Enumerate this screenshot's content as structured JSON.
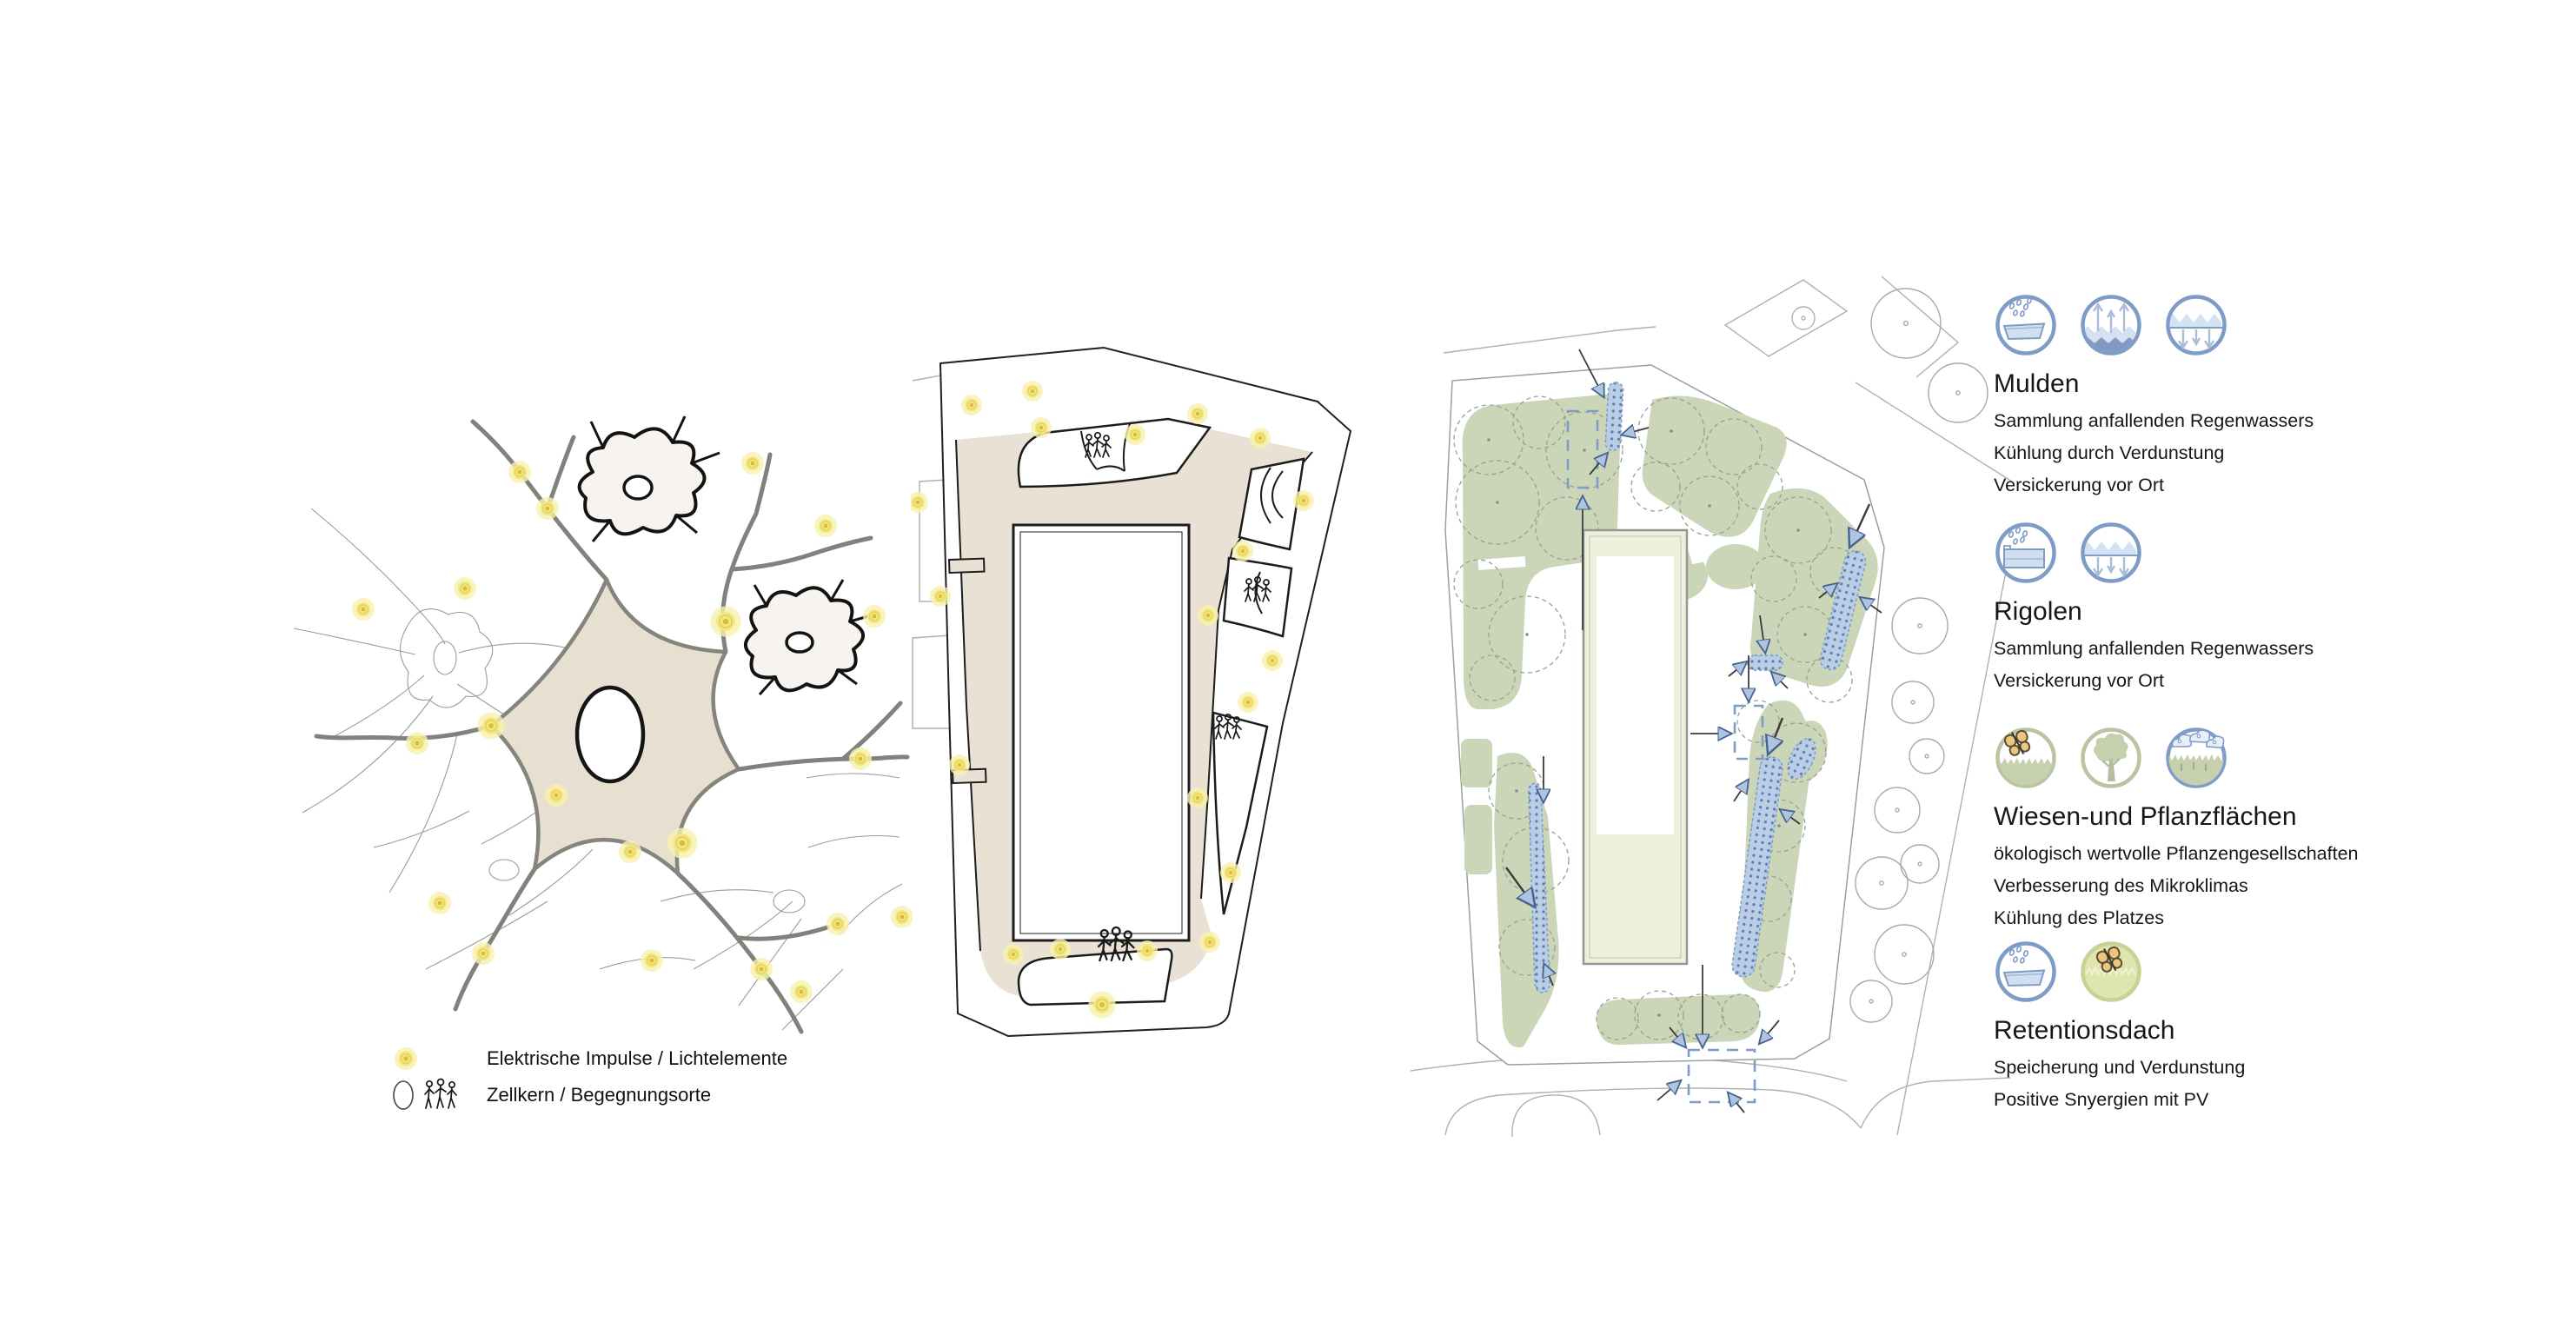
{
  "left_panel": {
    "name": "Neuron concept diagram",
    "legend": {
      "items": [
        {
          "icon": "light-dot-icon",
          "label": "Elektrische Impulse / Lichtelemente"
        },
        {
          "icon": "cell-people-icon",
          "label": "Zellkern / Begegnungsorte"
        }
      ]
    }
  },
  "middle_panel": {
    "name": "Site plan with light elements and meeting places"
  },
  "right_panel": {
    "name": "Site plan with water and planting measures"
  },
  "right_legend": {
    "sections": [
      {
        "title": "Mulden",
        "icons": [
          "rain-collection-icon",
          "evaporation-icon",
          "infiltration-icon"
        ],
        "lines": [
          "Sammlung anfallenden Regenwassers",
          "Kühlung durch Verdunstung",
          "Versickerung vor Ort"
        ]
      },
      {
        "title": "Rigolen",
        "icons": [
          "rain-storage-icon",
          "infiltration-icon"
        ],
        "lines": [
          "Sammlung anfallenden Regenwassers",
          "Versickerung vor Ort"
        ]
      },
      {
        "title": "Wiesen-und Pflanzflächen",
        "icons": [
          "butterfly-meadow-icon",
          "tree-icon",
          "clouds-meadow-icon"
        ],
        "lines": [
          "ökologisch wertvolle Pflanzengesellschaften",
          "Verbesserung des Mikroklimas",
          "Kühlung des Platzes"
        ]
      },
      {
        "title": "Retentionsdach",
        "icons": [
          "rain-collection-icon",
          "butterfly-roof-icon"
        ],
        "lines": [
          "Speicherung und Verdunstung",
          "Positive Snyergien mit PV"
        ]
      }
    ]
  },
  "colors": {
    "accent_blue": "#7f9cc7",
    "swale_blue": "#b9cde6",
    "sage_green": "#cbd5b8",
    "roof_green": "#edf0da",
    "path_beige": "#e9e1d3",
    "soma_beige": "#e7dfd0",
    "glow_yellow": "#f3e684",
    "butterfly_orange": "#ecc57e"
  }
}
